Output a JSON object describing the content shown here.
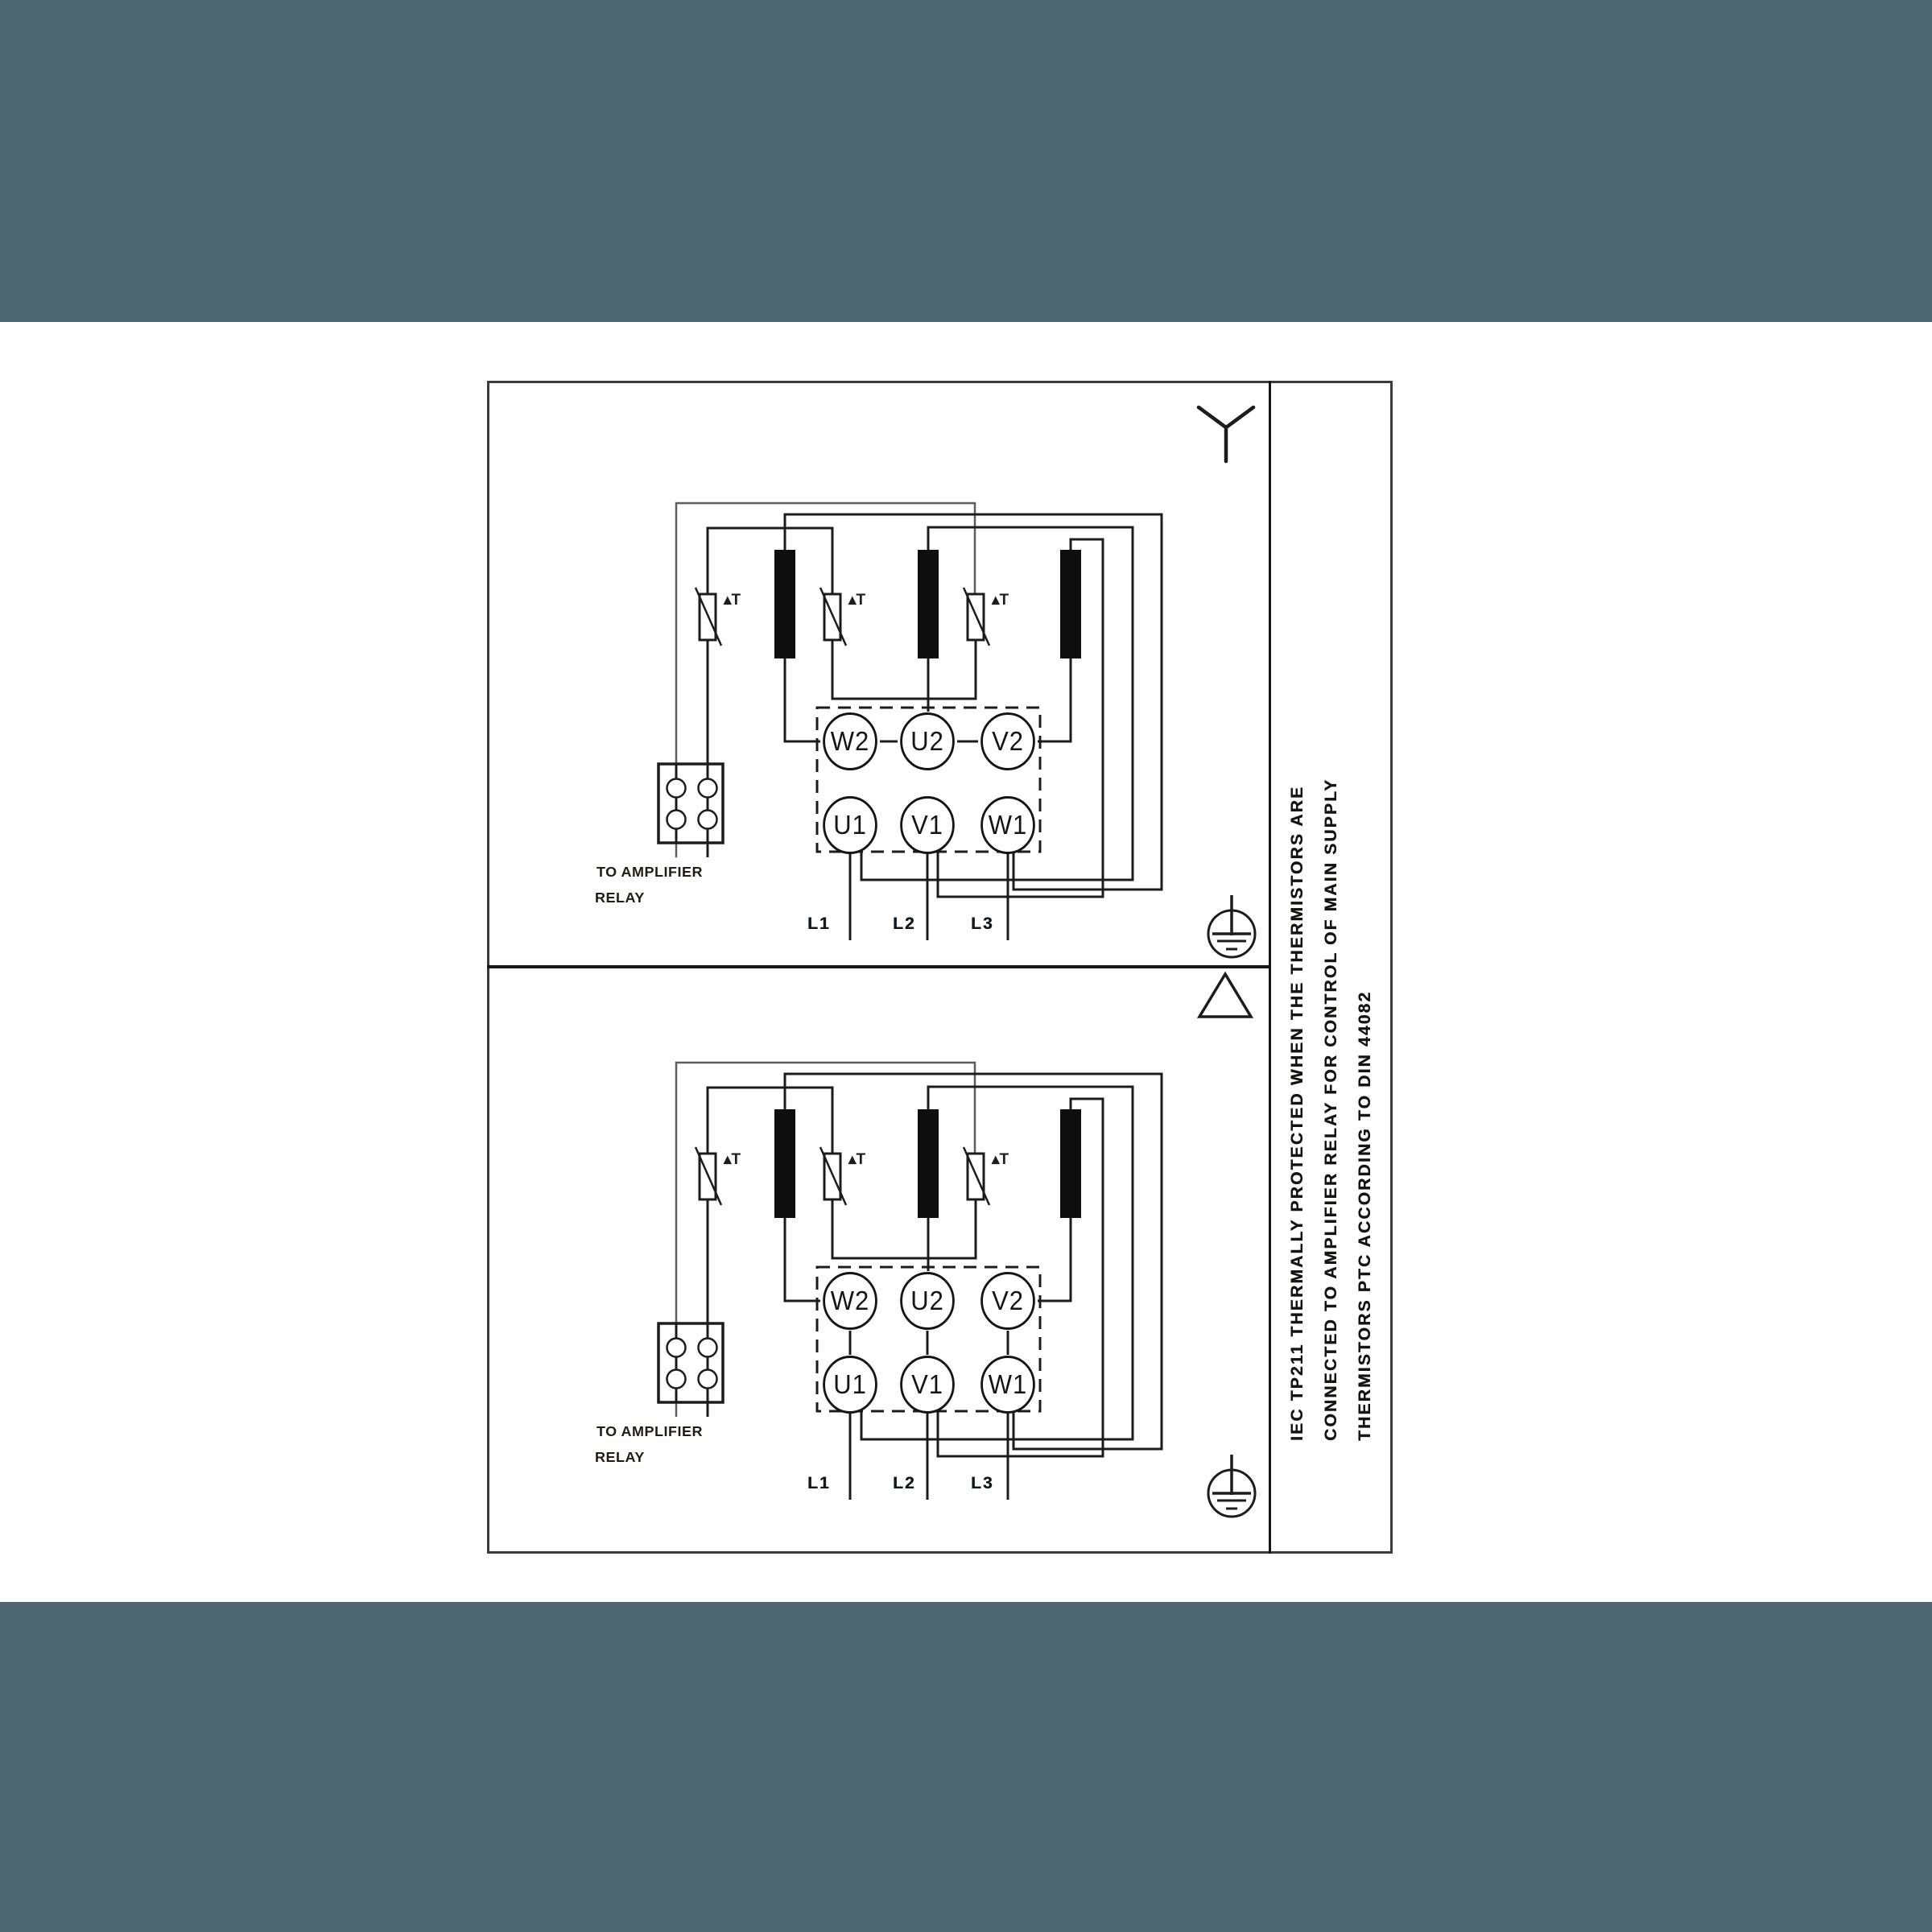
{
  "colors": {
    "band": "#4b6671",
    "ink": "#1c1c1c",
    "paper": "#ffffff"
  },
  "note": {
    "lines": [
      "IEC TP211 THERMALLY PROTECTED WHEN THE THERMISTORS ARE",
      "CONNECTED TO AMPLIFIER RELAY FOR CONTROL OF MAIN SUPPLY",
      "THERMISTORS PTC ACCORDING TO DIN 44082"
    ]
  },
  "halves": [
    {
      "connection": "star",
      "terminals_top": [
        "W2",
        "U2",
        "V2"
      ],
      "terminals_bottom": [
        "U1",
        "V1",
        "W1"
      ],
      "supply": [
        "L1",
        "L2",
        "L3"
      ],
      "relay_line1": "TO AMPLIFIER",
      "relay_line2": "RELAY",
      "thermistor_label": "▴T"
    },
    {
      "connection": "delta",
      "terminals_top": [
        "W2",
        "U2",
        "V2"
      ],
      "terminals_bottom": [
        "U1",
        "V1",
        "W1"
      ],
      "supply": [
        "L1",
        "L2",
        "L3"
      ],
      "relay_line1": "TO AMPLIFIER",
      "relay_line2": "RELAY",
      "thermistor_label": "▴T"
    }
  ]
}
